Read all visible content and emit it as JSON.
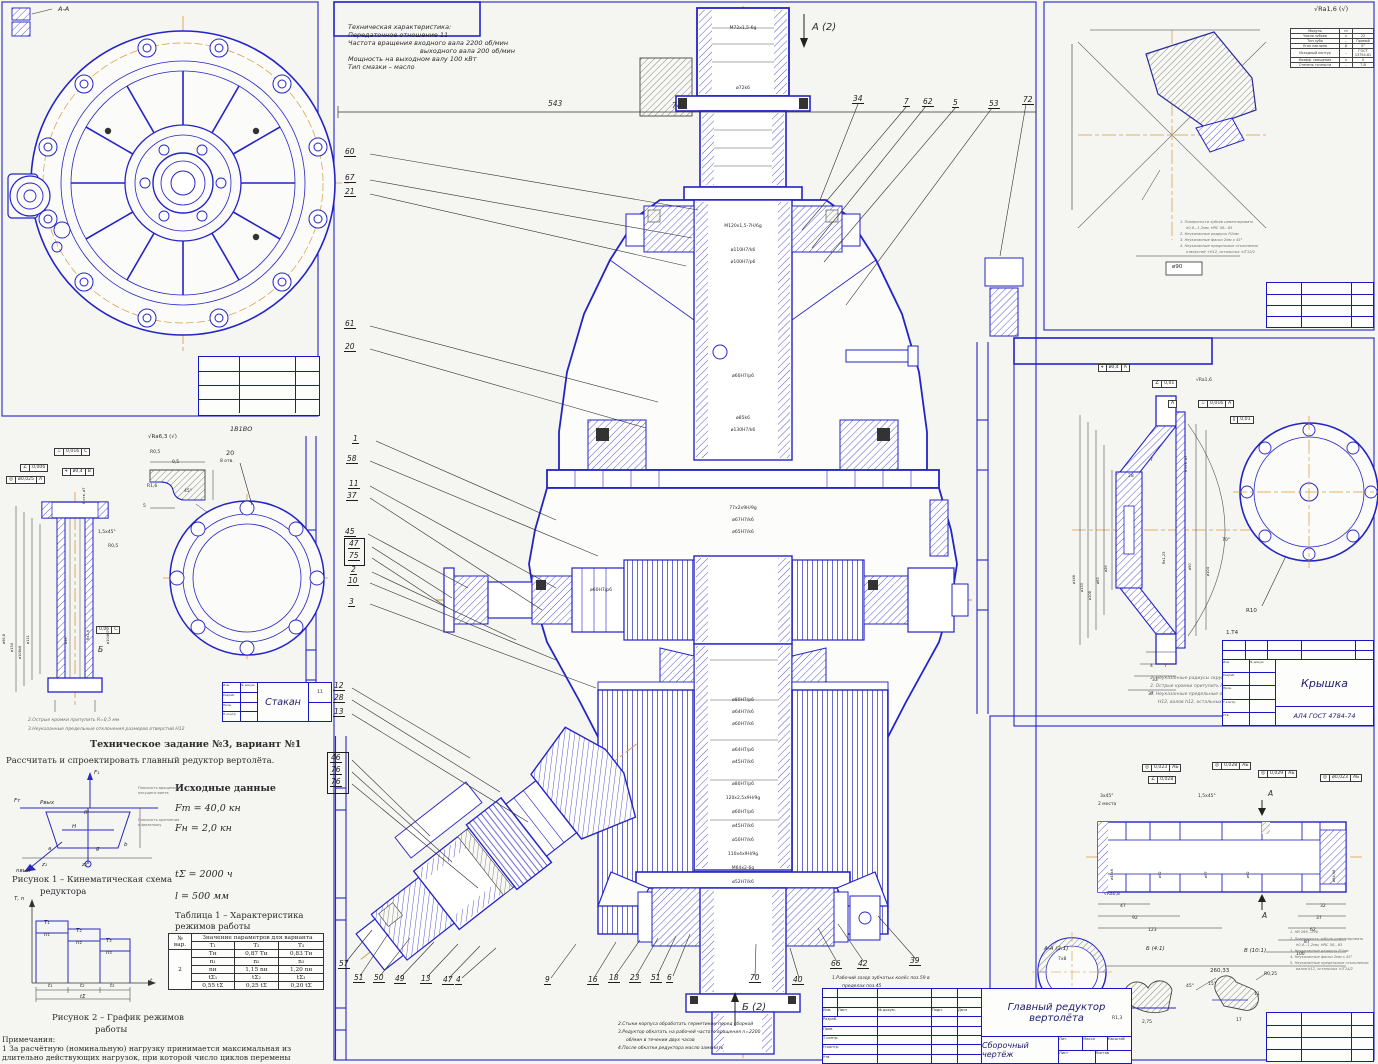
{
  "palette": {
    "blue": "#2323c6",
    "ink": "#2b2b2b",
    "centerline": "#d79a3e",
    "frame": "#2525c9"
  },
  "corner_label": "А-А",
  "tech_spec": {
    "lines": [
      "Техническая характеристика:",
      "Передаточное отношение 11",
      "Частота вращения входного вала 2200 об/мин",
      "выходного вала 200 об/мин",
      "Мощность на выходном валу 100 кВт",
      "Тип смазки – масло"
    ]
  },
  "center": {
    "section_top": "А (2)",
    "section_bottom": "Б (2)",
    "dim_543": "543",
    "dim_74": "74",
    "callouts_top": [
      "34",
      "7",
      "62",
      "5",
      "53",
      "72"
    ],
    "callouts_left": [
      "60",
      "67",
      "21",
      "61",
      "20",
      "1",
      "58",
      "11",
      "37",
      "45",
      "47",
      "75",
      "2",
      "10",
      "3",
      "12",
      "28",
      "13",
      "46",
      "76",
      "76"
    ],
    "callouts_bottom": [
      "57",
      "51",
      "50",
      "49",
      "13",
      "47",
      "4",
      "9",
      "16",
      "18",
      "23",
      "51",
      "6",
      "70",
      "40",
      "66",
      "42",
      "39"
    ],
    "fits": [
      "М72х1,5-6g",
      "ø72k6",
      "М120х1,5-7Н/6g",
      "ø110Н7/k6",
      "ø100Н7/р6",
      "ø60Н7/р6",
      "ø85k6",
      "ø130Н7/k6",
      "77х2х9Н/9g",
      "ø67Н7/k6",
      "ø65Н7/k6",
      "ø60Н7/р6",
      "ø80Н7/р6",
      "ø64Н7/k6",
      "ø60Н7/k6",
      "ø64Н7/р6",
      "ø45Н7/k6",
      "ø80Н7/р6",
      "120х2,5х9Н/9g",
      "ø60Н7/р6",
      "ø45Н7/k6",
      "ø50Н7/k6",
      "110х4х9Н/9g",
      "М64х2-6g",
      "ø52Н7/k6"
    ],
    "note1a": "1.Рабочий зазор зубчатых колёс поз.59 в",
    "note1b": "пределах поз.45",
    "note2": "2.Стыки корпуса обработать герметиком перед сборкой",
    "note3": "3.Редуктор обкатать на рабочей частоте вращения n=2200",
    "note3b": "об/мин в течении двух часов",
    "note4": "4.После обкатки редуктора масло заменить",
    "title": "Главный редуктор вертолёта",
    "doc_type": "Сборочный чертёж"
  },
  "tb": {
    "cols": [
      "Изм.",
      "Лист",
      "№ докум.",
      "Подп.",
      "Дата"
    ],
    "rows": [
      "Разраб.",
      "Пров.",
      "Т.контр.",
      "Н.контр.",
      "Утв."
    ],
    "lit": "Лит.",
    "mass": "Масса",
    "scale": "Масштаб",
    "sheet": "Лист",
    "sheets": "Листов"
  },
  "task": {
    "heading": "Техническое задание №3, вариант №1",
    "body": "Рассчитать и спроектировать главный редуктор вертолёта.",
    "data_heading": "Исходные данные",
    "f1": "Fт = 40,0 кн",
    "f2": "Fн = 2,0 кн",
    "t1": "tΣ = 2000 ч",
    "t2": "l = 500 мм",
    "fig1_caption_1": "Рисунок 1 – Кинематическая схема",
    "fig1_caption_2": "редуктора",
    "fig2_caption_1": "Рисунок 2 – График режимов",
    "fig2_caption_2": "работы",
    "table_caption_1": "Таблица 1 – Характеристика",
    "table_caption_2": "режимов работы",
    "notes_heading": "Примечания:",
    "note1": "1 За расчётную (номинальную) нагрузку принимается максимальная из",
    "note2": "длительно действующих нагрузок, при которой число   циклов перемены",
    "fig1_labels": {
      "f1": "F₁",
      "ft": "Fт",
      "pvyh": "Pвых",
      "iii": "III",
      "h": "H",
      "a": "a",
      "g": "g",
      "b": "b",
      "z1": "z₁",
      "z2": "z₂",
      "nvyh": "nвых",
      "ann1": "Плоскость вращения",
      "ann2": "несущего винта",
      "ann3": "Плоскость крепления",
      "ann4": "к фюзеляжу"
    },
    "fig2_labels": {
      "axis_y": "Т, n",
      "axis_x": "t",
      "T1": "Т₁",
      "n1": "n₁",
      "T2": "Т₂",
      "n2": "n₂",
      "T3": "Т₃",
      "n3": "n₃",
      "t1": "t₁",
      "t2": "t₂",
      "t3": "t₃",
      "ts": "tΣ"
    }
  },
  "table1": {
    "col_no": "№ вар.",
    "col_val": "Значение параметров для варианта",
    "variant": "2",
    "h1": [
      "Т₁",
      "Т₂",
      "Т₃"
    ],
    "r1": [
      "Тн",
      "0,87 Тн",
      "0,83 Тн"
    ],
    "h2": [
      "n₁",
      "n₂",
      "n₃"
    ],
    "r2": [
      "nн",
      "1,15 nн",
      "1,20 nн"
    ],
    "h3": [
      "tΣ₁",
      "tΣ₂",
      "tΣ₃"
    ],
    "r3": [
      "0,55 tΣ",
      "0,25 tΣ",
      "0,20 tΣ"
    ]
  },
  "stakan": {
    "title": "Стакан",
    "sheet_no": "11",
    "note2": "2.Острые кромки притупить R=0,5 мм",
    "note3": "3.Неуказанные предельные отклонения размеров отверстий Н12",
    "surface": "√Ra6,3 (√)",
    "view_label": "1В1ВО",
    "gdt": {
      "f1s": "◎",
      "f1v": "ø0,025",
      "f1d": "А",
      "f2s": "∠",
      "f2v": "0,006",
      "f3s": "⊥",
      "f3v": "0,016",
      "f3d": "С",
      "f4s": "⌖",
      "f4v": "ø0,4",
      "f4d": "В",
      "holes": "8 отв. ø7",
      "flat": "0,06",
      "flatd": "С"
    },
    "corner": {
      "r05": "R0,5",
      "r16": "R1,6",
      "a45": "45°",
      "d5": "5",
      "d05": "0,5"
    },
    "ring": {
      "d20": "20",
      "holes": "8 отв."
    },
    "dims": {
      "d1": "ø96,8",
      "d2": "ø134",
      "d3": "ø108k6",
      "d4": "ø111",
      "d5": "ø98",
      "d6": "ø104Н7",
      "ra": "Ra1,6",
      "ch": "1,5х45°",
      "r": "R0,5",
      "b": "Б"
    }
  },
  "cover": {
    "title": "Крышка",
    "material": "АЛ4 ГОСТ 4784-74",
    "pre": "1.Т4",
    "notes": [
      "2. Неуказанные радиусы скруглений R2,5мм",
      "3. Острые кромки притупить R0,3мм max",
      "4. Неуказанные предельные отклонения размеров отверстий по",
      "Н12, валов h12, остальных ±JT12/2"
    ],
    "gdt": {
      "f1s": "⌖",
      "f1v": "ø0,4",
      "f1d": "А",
      "f2s": "∠",
      "f2v": "0,01",
      "f3": "А",
      "f4s": "⊥",
      "f4v": "0,016",
      "f4d": "А",
      "f5s": "∥",
      "f5v": "0,01",
      "ra16": "√Ra1,6",
      "holes": "8 отв. ø7"
    },
    "dims": {
      "d148": "ø148",
      "d133": "ø133",
      "d108": "ø108",
      "d63": "ø63",
      "d26": "ø26",
      "w28": "28",
      "w7": "7",
      "d90": "ø90",
      "a70": "70°",
      "d104": "ø104",
      "ra125": "Ra1,25",
      "b4": "4",
      "b7": "7",
      "b33": "33",
      "b37": "37",
      "r10": "R10"
    }
  },
  "gear": {
    "surface": "√Ra1,6 (√)",
    "dim_d90": "ø90",
    "table": [
      [
        "Модуль",
        "m",
        ""
      ],
      [
        "Число зубьев",
        "z",
        "22"
      ],
      [
        "Тип зуба",
        "–",
        "Прямой"
      ],
      [
        "Угол наклона",
        "β",
        "0°"
      ],
      [
        "Исходный контур",
        "–",
        "ГОСТ 13754-81"
      ],
      [
        "Коэфф. смещения",
        "x",
        "0"
      ],
      [
        "Степень точности",
        "–",
        "7-В"
      ]
    ],
    "notes": [
      "1. Поверхности зубьев цементировать",
      "h0,8...1,2мм, HRC 58...63",
      "2. Неуказанные радиусы R1мм",
      "3. Неуказанные фаски 2мм х 45°",
      "4. Неуказанные предельные отклонения",
      "отверстий +Н12, остальных ±IT12/2"
    ]
  },
  "shaft": {
    "notes": [
      "1. НВ 266...290",
      "2. Поверхность зубьев цементировать",
      "h0,8...1,2мм, HRC 58...63",
      "3. Неуказанные радиусы R1мм",
      "4. Неуказанные фаски 2мм х 45°",
      "5. Неуказанные предельные отклонения:",
      "валов h12, остальных ±IT14/2"
    ],
    "sec_a": "А",
    "sec_aa": "А-А (2:1)",
    "view_b": "Б (4:1)",
    "view_v": "В (10:1)",
    "k78": "7х8",
    "gdt": {
      "g1s": "◎",
      "g1v": "0,023",
      "g1d": "АБ",
      "g2s": "∠",
      "g2v": "0,028",
      "g3s": "◎",
      "g3v": "0,028",
      "g3d": "АБ",
      "g4s": "◎",
      "g4v": "0,029",
      "g4d": "АБ",
      "g5s": "◎",
      "g5v": "ø0,023",
      "g5d": "АБ"
    },
    "dims": {
      "ch1": "3х45°",
      "pl": "2 места",
      "ch2": "1,5х45°",
      "ra08": "√Ra0,8",
      "l1": "47",
      "l2": "92",
      "l3": "123",
      "r1": "32",
      "r2": "37",
      "r3": "62",
      "r4": "87",
      "r5": "100",
      "total": "260,33",
      "t1": "R1,3",
      "t2": "2,75",
      "t3": "45°",
      "t4": "15°",
      "t5": "R0,25",
      "t6": "R0,3",
      "t7": "17",
      "t8": "11",
      "d1": "ø45k6",
      "d2": "ø52",
      "d3": "ø57",
      "d4": "ø62",
      "d5": "ø84,96"
    }
  }
}
